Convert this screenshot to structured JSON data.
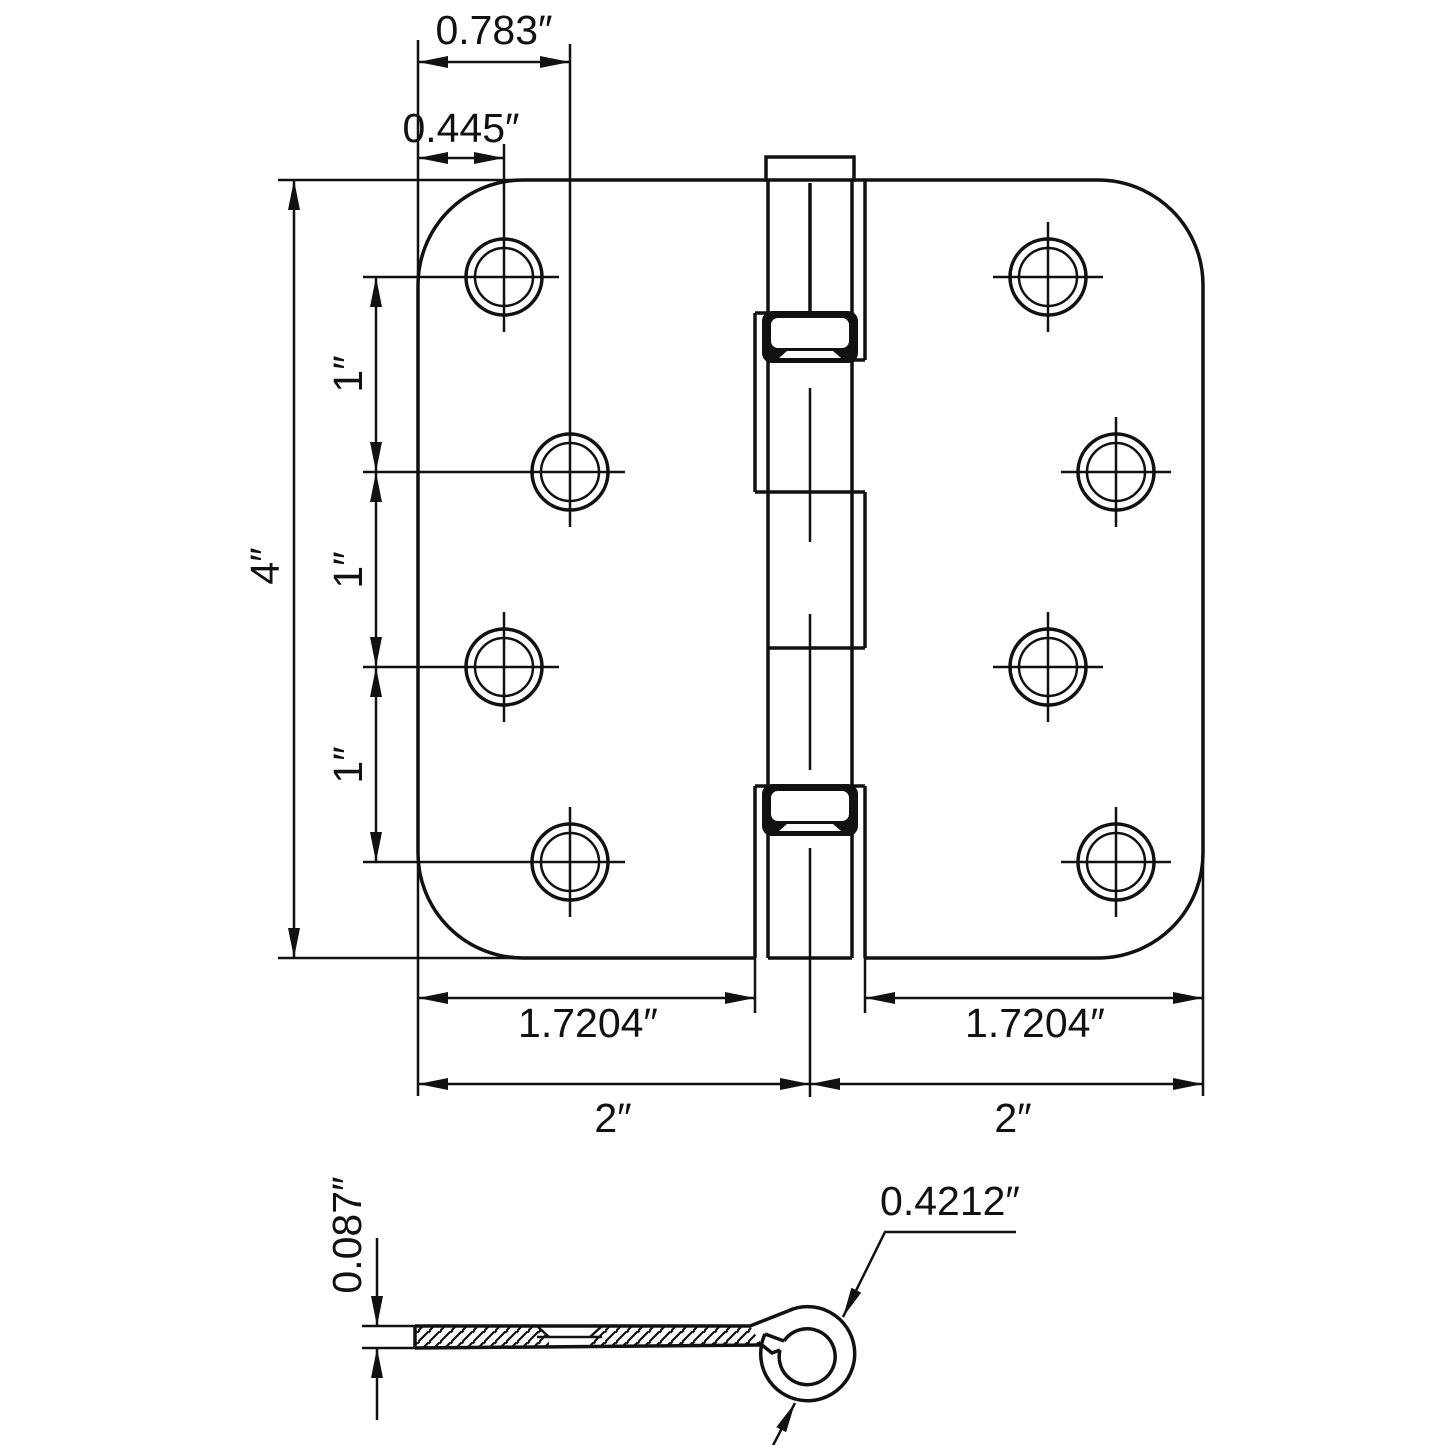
{
  "drawing": {
    "type": "hinge technical dimension drawing",
    "colors": {
      "ink": "#111111",
      "background": "#ffffff"
    },
    "top_view": {
      "horizontal_dims": {
        "hole_offset_outer": "0.783″",
        "hole_offset_inner": "0.445″",
        "leaf_flat_left": "1.7204″",
        "leaf_flat_right": "1.7204″",
        "leaf_width_left": "2″",
        "leaf_width_right": "2″"
      },
      "vertical_dims": {
        "overall_height": "4″",
        "hole_spacing_top": "1″",
        "hole_spacing_middle": "1″",
        "hole_spacing_bottom": "1″"
      }
    },
    "side_view": {
      "leaf_thickness": "0.087″",
      "knuckle_diameter": "0.4212″"
    }
  }
}
